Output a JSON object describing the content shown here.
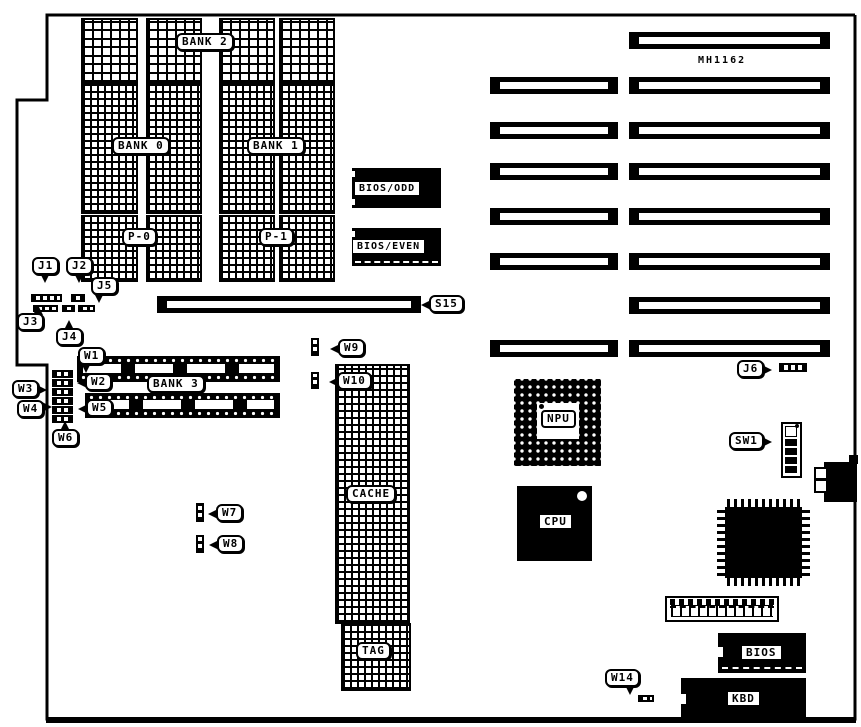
{
  "board": {
    "model": "MH1162"
  },
  "memory": {
    "bank0": "BANK 0",
    "bank1": "BANK 1",
    "bank2": "BANK 2",
    "bank3": "BANK 3",
    "p0": "P-0",
    "p1": "P-1",
    "cache": "CACHE",
    "tag": "TAG"
  },
  "chips": {
    "bios_odd": "BIOS/ODD",
    "bios_even": "BIOS/EVEN",
    "npu": "NPU",
    "cpu": "CPU",
    "bios": "BIOS",
    "kbd": "KBD"
  },
  "jumpers": {
    "j1": "J1",
    "j2": "J2",
    "j3": "J3",
    "j4": "J4",
    "j5": "J5",
    "j6": "J6",
    "w1": "W1",
    "w2": "W2",
    "w3": "W3",
    "w4": "W4",
    "w5": "W5",
    "w6": "W6",
    "w7": "W7",
    "w8": "W8",
    "w9": "W9",
    "w10": "W10",
    "w14": "W14"
  },
  "switches": {
    "sw1": "SW1"
  },
  "slots": {
    "s15": "S15"
  },
  "colors": {
    "ink": "#000000",
    "paper": "#ffffff"
  }
}
